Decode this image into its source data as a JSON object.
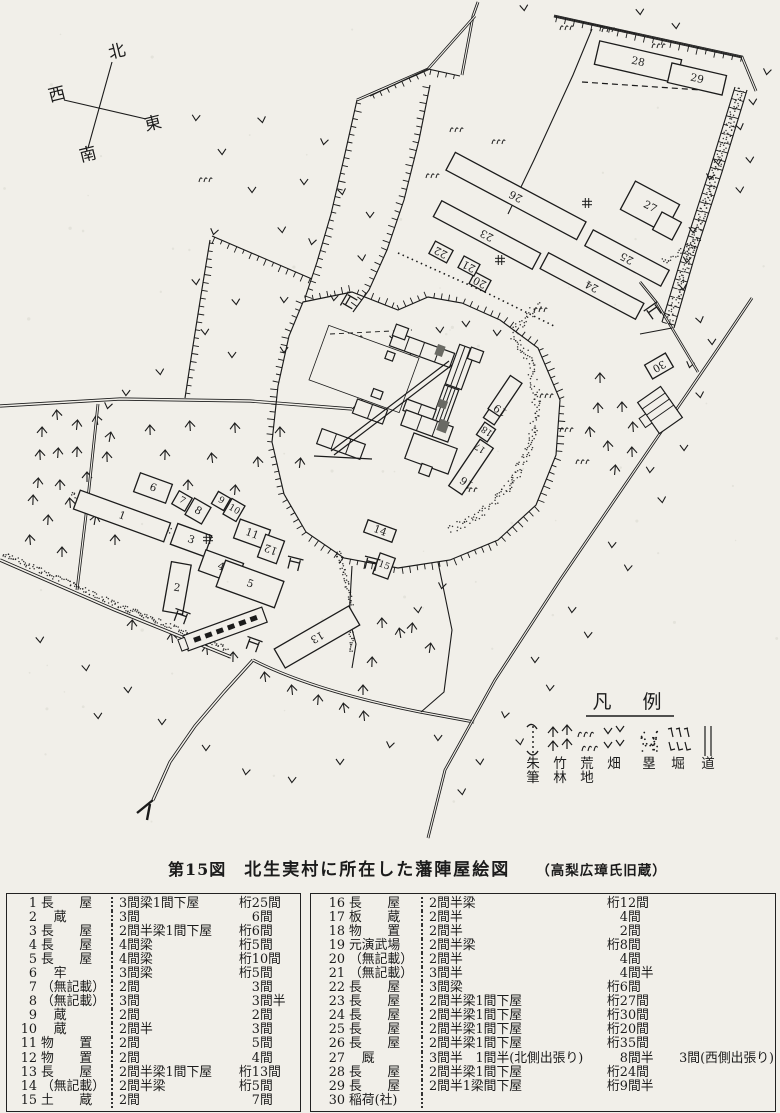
{
  "caption": {
    "fig_no": "第15図",
    "title": "北生実村に所在した藩陣屋絵図",
    "source": "（高梨広璋氏旧蔵）"
  },
  "compass": {
    "north": "北",
    "west": "西",
    "east": "東",
    "south": "南"
  },
  "map": {
    "ink_color": "#1b1b1b",
    "paper_color": "#f1efe9",
    "legend": {
      "title": "凡　例",
      "items": [
        {
          "label": "朱筆",
          "symbol": "shuhitsu-mark"
        },
        {
          "label": "竹林",
          "symbol": "bamboo-mark"
        },
        {
          "label": "荒地",
          "symbol": "wasteland-mark"
        },
        {
          "label": "畑",
          "symbol": "field-mark"
        },
        {
          "label": "塁",
          "symbol": "rampart-mark"
        },
        {
          "label": "堀",
          "symbol": "moat-mark"
        },
        {
          "label": "道",
          "symbol": "road-mark"
        }
      ]
    },
    "buildings": [
      {
        "n": "1",
        "x": 122,
        "y": 516,
        "w": 96,
        "h": 20,
        "rot": 20,
        "lr": 0
      },
      {
        "n": "2",
        "x": 177,
        "y": 588,
        "w": 20,
        "h": 50,
        "rot": 10,
        "lr": 0
      },
      {
        "n": "3",
        "x": 191,
        "y": 540,
        "w": 36,
        "h": 22,
        "rot": 20,
        "lr": 0
      },
      {
        "n": "4",
        "x": 221,
        "y": 567,
        "w": 40,
        "h": 22,
        "rot": 20,
        "lr": 0
      },
      {
        "n": "5",
        "x": 250,
        "y": 584,
        "w": 62,
        "h": 28,
        "rot": 20,
        "lr": 0
      },
      {
        "n": "6",
        "x": 153,
        "y": 488,
        "w": 34,
        "h": 20,
        "rot": 20,
        "lr": 0
      },
      {
        "n": "7",
        "x": 182,
        "y": 501,
        "w": 15,
        "h": 15,
        "rot": 30,
        "lr": 0
      },
      {
        "n": "8",
        "x": 198,
        "y": 511,
        "w": 19,
        "h": 19,
        "rot": 30,
        "lr": 0
      },
      {
        "n": "9",
        "x": 221,
        "y": 501,
        "w": 14,
        "h": 14,
        "rot": 30,
        "lr": 0
      },
      {
        "n": "10",
        "x": 234,
        "y": 510,
        "w": 15,
        "h": 18,
        "rot": 30,
        "lr": 0
      },
      {
        "n": "11",
        "x": 252,
        "y": 534,
        "w": 32,
        "h": 20,
        "rot": 20,
        "lr": 0
      },
      {
        "n": "12",
        "x": 271,
        "y": 549,
        "w": 20,
        "h": 24,
        "rot": 20,
        "lr": 180
      },
      {
        "n": "13",
        "x": 317,
        "y": 637,
        "w": 86,
        "h": 22,
        "rot": -30,
        "lr": 180
      },
      {
        "n": "14",
        "x": 380,
        "y": 531,
        "w": 30,
        "h": 13,
        "rot": 20,
        "lr": 0
      },
      {
        "n": "15",
        "x": 384,
        "y": 566,
        "w": 16,
        "h": 22,
        "rot": 20,
        "lr": 0
      },
      {
        "n": "16",
        "x": 471,
        "y": 467,
        "w": 56,
        "h": 16,
        "rot": -56,
        "lr": -90,
        "ox": -15,
        "oy": 5
      },
      {
        "n": "17",
        "x": 486,
        "y": 432,
        "w": 15,
        "h": 13,
        "rot": -56,
        "lr": -90,
        "ox": -16,
        "oy": 4
      },
      {
        "n": "18",
        "x": 493,
        "y": 415,
        "w": 15,
        "h": 13,
        "rot": -56,
        "lr": -90,
        "ox": -16,
        "oy": 4
      },
      {
        "n": "19",
        "x": 505,
        "y": 396,
        "w": 40,
        "h": 14,
        "rot": -56,
        "lr": -90,
        "ox": -14,
        "oy": 4
      },
      {
        "n": "20",
        "x": 480,
        "y": 282,
        "w": 18,
        "h": 13,
        "rot": 28,
        "lr": 180
      },
      {
        "n": "21",
        "x": 469,
        "y": 266,
        "w": 18,
        "h": 13,
        "rot": 28,
        "lr": 180
      },
      {
        "n": "22",
        "x": 441,
        "y": 252,
        "w": 20,
        "h": 14,
        "rot": 28,
        "lr": 180
      },
      {
        "n": "23",
        "x": 487,
        "y": 235,
        "w": 112,
        "h": 18,
        "rot": 28,
        "lr": 180
      },
      {
        "n": "24",
        "x": 592,
        "y": 286,
        "w": 108,
        "h": 18,
        "rot": 28,
        "lr": 180
      },
      {
        "n": "25",
        "x": 627,
        "y": 258,
        "w": 86,
        "h": 18,
        "rot": 28,
        "lr": 180
      },
      {
        "n": "26",
        "x": 516,
        "y": 196,
        "w": 148,
        "h": 20,
        "rot": 28,
        "lr": 180
      },
      {
        "n": "27",
        "x": 650,
        "y": 207,
        "w": 50,
        "h": 32,
        "rot": 28,
        "lr": 0
      },
      {
        "n": "",
        "x": 667,
        "y": 226,
        "w": 22,
        "h": 20,
        "rot": 28,
        "lr": 0
      },
      {
        "n": "28",
        "x": 638,
        "y": 62,
        "w": 84,
        "h": 24,
        "rot": 13,
        "lr": 0
      },
      {
        "n": "29",
        "x": 697,
        "y": 79,
        "w": 56,
        "h": 20,
        "rot": 13,
        "lr": 0
      },
      {
        "n": "30",
        "x": 659,
        "y": 366,
        "w": 24,
        "h": 16,
        "rot": -30,
        "lr": 180
      }
    ]
  },
  "tables": {
    "left": {
      "rows": [
        {
          "no": "1",
          "name": "長　　屋",
          "spec": "3間梁1間下屋",
          "size": "桁25間"
        },
        {
          "no": "2",
          "name": "　蔵",
          "spec": "3間",
          "size": "　6間"
        },
        {
          "no": "3",
          "name": "長　　屋",
          "spec": "2間半梁1間下屋",
          "size": "桁6間"
        },
        {
          "no": "4",
          "name": "長　　屋",
          "spec": "4間梁",
          "size": "桁5間"
        },
        {
          "no": "5",
          "name": "長　　屋",
          "spec": "4間梁",
          "size": "桁10間"
        },
        {
          "no": "6",
          "name": "　牢",
          "spec": "3間梁",
          "size": "桁5間"
        },
        {
          "no": "7",
          "name": "（無記載）",
          "spec": "2間",
          "size": "　3間"
        },
        {
          "no": "8",
          "name": "（無記載）",
          "spec": "3間",
          "size": "　3間半"
        },
        {
          "no": "9",
          "name": "　蔵",
          "spec": "2間",
          "size": "　2間"
        },
        {
          "no": "10",
          "name": "　蔵",
          "spec": "2間半",
          "size": "　3間"
        },
        {
          "no": "11",
          "name": "物　　置",
          "spec": "2間",
          "size": "　5間"
        },
        {
          "no": "12",
          "name": "物　　置",
          "spec": "2間",
          "size": "　4間"
        },
        {
          "no": "13",
          "name": "長　　屋",
          "spec": "2間半梁1間下屋",
          "size": "桁13間"
        },
        {
          "no": "14",
          "name": "（無記載）",
          "spec": "2間半梁",
          "size": "桁5間"
        },
        {
          "no": "15",
          "name": "土　　蔵",
          "spec": "2間",
          "size": "　7間"
        }
      ]
    },
    "right": {
      "rows": [
        {
          "no": "16",
          "name": "長　　屋",
          "spec": "2間半梁",
          "size": "桁12間"
        },
        {
          "no": "17",
          "name": "板　　蔵",
          "spec": "2間半",
          "size": "　4間"
        },
        {
          "no": "18",
          "name": "物　　置",
          "spec": "2間半",
          "size": "　2間"
        },
        {
          "no": "19",
          "name": "元演武場",
          "spec": "2間半梁",
          "size": "桁8間"
        },
        {
          "no": "20",
          "name": "（無記載）",
          "spec": "2間半",
          "size": "　4間"
        },
        {
          "no": "21",
          "name": "（無記載）",
          "spec": "3間半",
          "size": "　4間半"
        },
        {
          "no": "22",
          "name": "長　　屋",
          "spec": "3間梁",
          "size": "桁6間"
        },
        {
          "no": "23",
          "name": "長　　屋",
          "spec": "2間半梁1間下屋",
          "size": "桁27間"
        },
        {
          "no": "24",
          "name": "長　　屋",
          "spec": "2間半梁1間下屋",
          "size": "桁30間"
        },
        {
          "no": "25",
          "name": "長　　屋",
          "spec": "2間半梁1間下屋",
          "size": "桁20間"
        },
        {
          "no": "26",
          "name": "長　　屋",
          "spec": "2間半梁1間下屋",
          "size": "桁35間"
        },
        {
          "no": "27",
          "name": "　厩",
          "spec": "3間半　1間半(北側出張り)",
          "size": "　8間半　　3間(西側出張り)"
        },
        {
          "no": "28",
          "name": "長　　屋",
          "spec": "2間半梁1間下屋",
          "size": "桁24間"
        },
        {
          "no": "29",
          "name": "長　　屋",
          "spec": "2間半1梁間下屋",
          "size": "桁9間半"
        },
        {
          "no": "30",
          "name": "稲荷(社)",
          "spec": "",
          "size": ""
        }
      ]
    }
  }
}
